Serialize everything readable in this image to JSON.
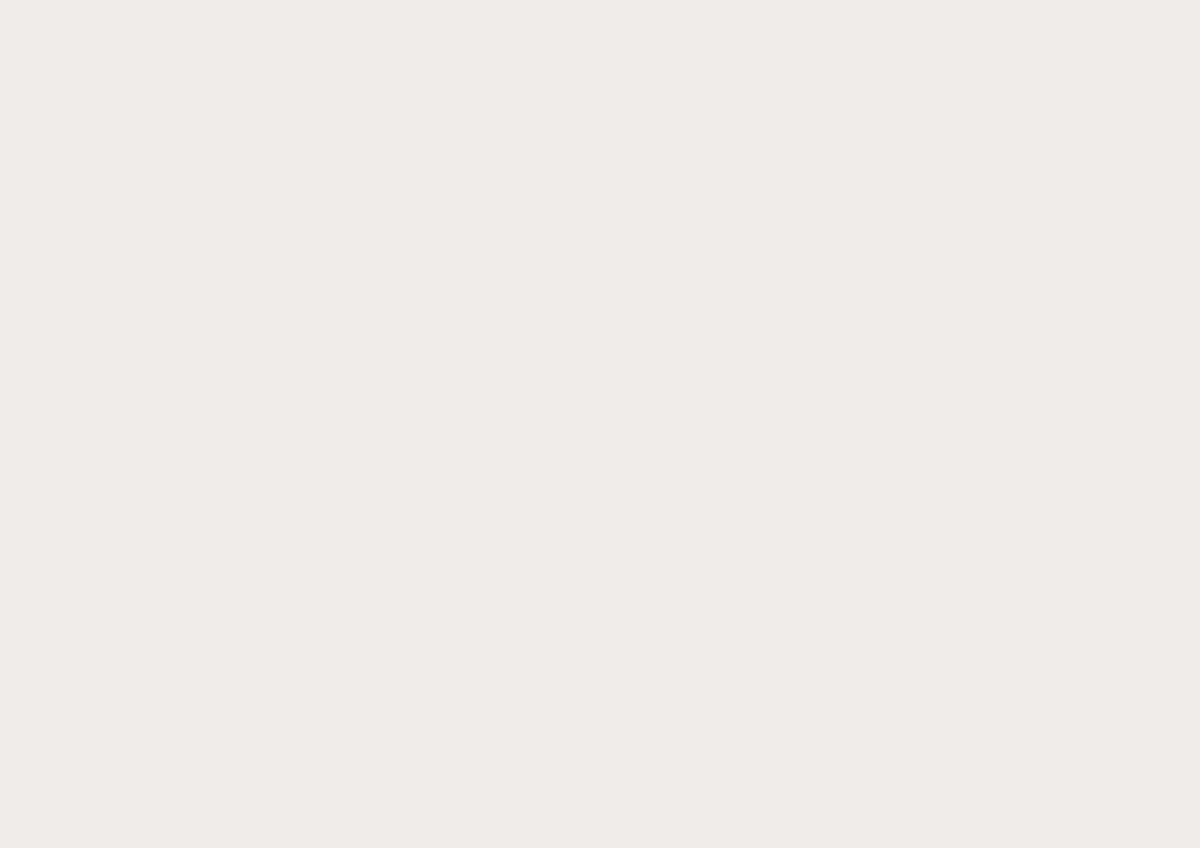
{
  "meta": {
    "domain": "Map",
    "kind": "architectural-masterplan-site-plan",
    "description": "Illustrated aerial masterplan of a riverside city: faded existing fabric, a highlighted central station quarter with pocket parks, teal water channels, beige plazas and white development parcels, a motorway interchange with an elevated stub viaduct, a fanning railway yard, and a densely wooded hill park above a curving residential quarter. No text labels are visible.",
    "visible_text": "none"
  },
  "palette": {
    "base": "#efedea",
    "river": "#aed8d7",
    "river_bank_green": "#dce6c3",
    "waterfront_pink": "#f7ebe7",
    "block": "#f0f0f1",
    "building_grey": "#b8bbc3",
    "building_light": "#d6d7da",
    "building_pink": "#f6e8e4",
    "road": "#dadbdd",
    "road_edge": "#b7b8bc",
    "plaza_beige": "#f1e4c3",
    "plaza_dot": "#c9a96a",
    "lawn": "#d5e0b8",
    "lawn_dark": "#c3d3a0",
    "canal_teal": "#3f7f75",
    "canal_teal_light": "#5ea193",
    "tree_olive": "#97ad7f",
    "tree_teal": "#5f9486",
    "tree_sage": "#a8bd9a",
    "hill_base": "#c6d2a8",
    "hill_tree": "#7e9a63",
    "proposed_white": "#fbfbfa",
    "proposed_outline": "#55565c",
    "accent_orange": "#e0a476",
    "rail_corridor": "#a3ba8c",
    "residential_pink": "#f2e8e2",
    "hedge_dark": "#6b8a57"
  },
  "regions": [
    {
      "id": "river",
      "label": "River"
    },
    {
      "id": "riverside-embankment",
      "label": "Riverside Embankment"
    },
    {
      "id": "river-bank-green",
      "label": "Green River Bank (north-east)"
    },
    {
      "id": "old-town-west",
      "label": "Existing Old Town Fabric (west)"
    },
    {
      "id": "city-north",
      "label": "Existing City Fabric (north)"
    },
    {
      "id": "grid-district-east",
      "label": "Grid District (east)"
    },
    {
      "id": "green-square-park",
      "label": "Green Square Park"
    },
    {
      "id": "riverside-park",
      "label": "Riverside Park Strip"
    },
    {
      "id": "pond-plaza",
      "label": "Pond Plaza"
    },
    {
      "id": "masterplan-site",
      "label": "Central Masterplan Site"
    },
    {
      "id": "north-pocket-park",
      "label": "North Pocket Park"
    },
    {
      "id": "south-pocket-park",
      "label": "South Pocket Park"
    },
    {
      "id": "water-channels",
      "label": "Teal Water Channels"
    },
    {
      "id": "central-plaza",
      "label": "Central Beige Plaza"
    },
    {
      "id": "development-parcels",
      "label": "White Development Parcels with Courtyards"
    },
    {
      "id": "ne-courtyard-block",
      "label": "Hatched Courtyard Block (north-east)"
    },
    {
      "id": "rail-corridor",
      "label": "Green Rail Corridor"
    },
    {
      "id": "main-station",
      "label": "Main Railway Station"
    },
    {
      "id": "station-triangle-canopy",
      "label": "Triangular Lattice Station Canopy"
    },
    {
      "id": "station-platforms",
      "label": "Station Platforms"
    },
    {
      "id": "office-complex",
      "label": "Office Complex South of Station"
    },
    {
      "id": "roof-trellis-garden",
      "label": "Roof Trellis Garden"
    },
    {
      "id": "railway-yard",
      "label": "Fanning Railway Yard"
    },
    {
      "id": "motorway-interchange",
      "label": "Motorway Interchange"
    },
    {
      "id": "elevated-motorway-stub",
      "label": "Elevated Motorway Stub"
    },
    {
      "id": "hill-park",
      "label": "Wooded Hill Park"
    },
    {
      "id": "hill-clearing",
      "label": "Hill Clearing"
    },
    {
      "id": "pond",
      "label": "Teal Pond"
    },
    {
      "id": "residential-quarter-southeast",
      "label": "Curving Residential Quarter (south-east)"
    },
    {
      "id": "bottom-left-grove",
      "label": "Tree Grove (bottom-left)"
    }
  ]
}
